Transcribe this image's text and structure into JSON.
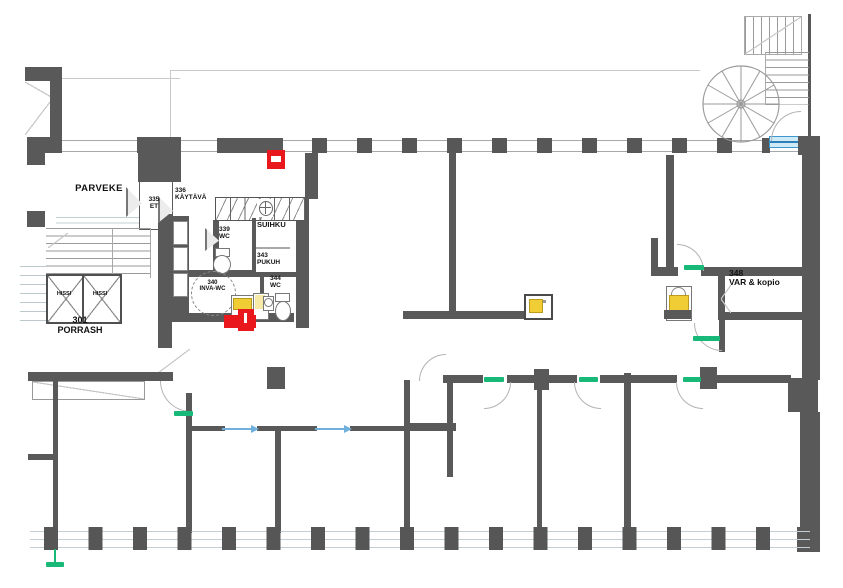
{
  "rooms": [
    {
      "id": "parveke",
      "number": "",
      "name": "PARVEKE"
    },
    {
      "id": "et-335",
      "number": "335",
      "name": "ET"
    },
    {
      "id": "kaytava-336",
      "number": "336",
      "name": "KÄYTÄVÄ"
    },
    {
      "id": "wc-339",
      "number": "339",
      "name": "WC"
    },
    {
      "id": "suihku",
      "number": "",
      "name": "SUIHKU"
    },
    {
      "id": "pukuh-343",
      "number": "343",
      "name": "PUKUH"
    },
    {
      "id": "wc-344",
      "number": "344",
      "name": "WC"
    },
    {
      "id": "inva-wc-340",
      "number": "340",
      "name": "INVA-WC"
    },
    {
      "id": "hissi-left",
      "number": "",
      "name": "HISSI"
    },
    {
      "id": "hissi-right",
      "number": "",
      "name": "HISSI"
    },
    {
      "id": "porrash-301",
      "number": "301",
      "name": "PORRASH"
    },
    {
      "id": "var-kopio-348",
      "number": "348",
      "name": "VAR & kopio"
    }
  ],
  "colors": {
    "wall": "#595959",
    "window_line": "#c3d0d3",
    "door_arc": "#b3b3b3",
    "safety_red": "#e8181d",
    "fixture_yellow": "#f0cc35",
    "door_tag_green": "#17b878",
    "exit_arrow_blue": "#6fb0dd",
    "window_sill_blue": "#cdeaf6"
  }
}
